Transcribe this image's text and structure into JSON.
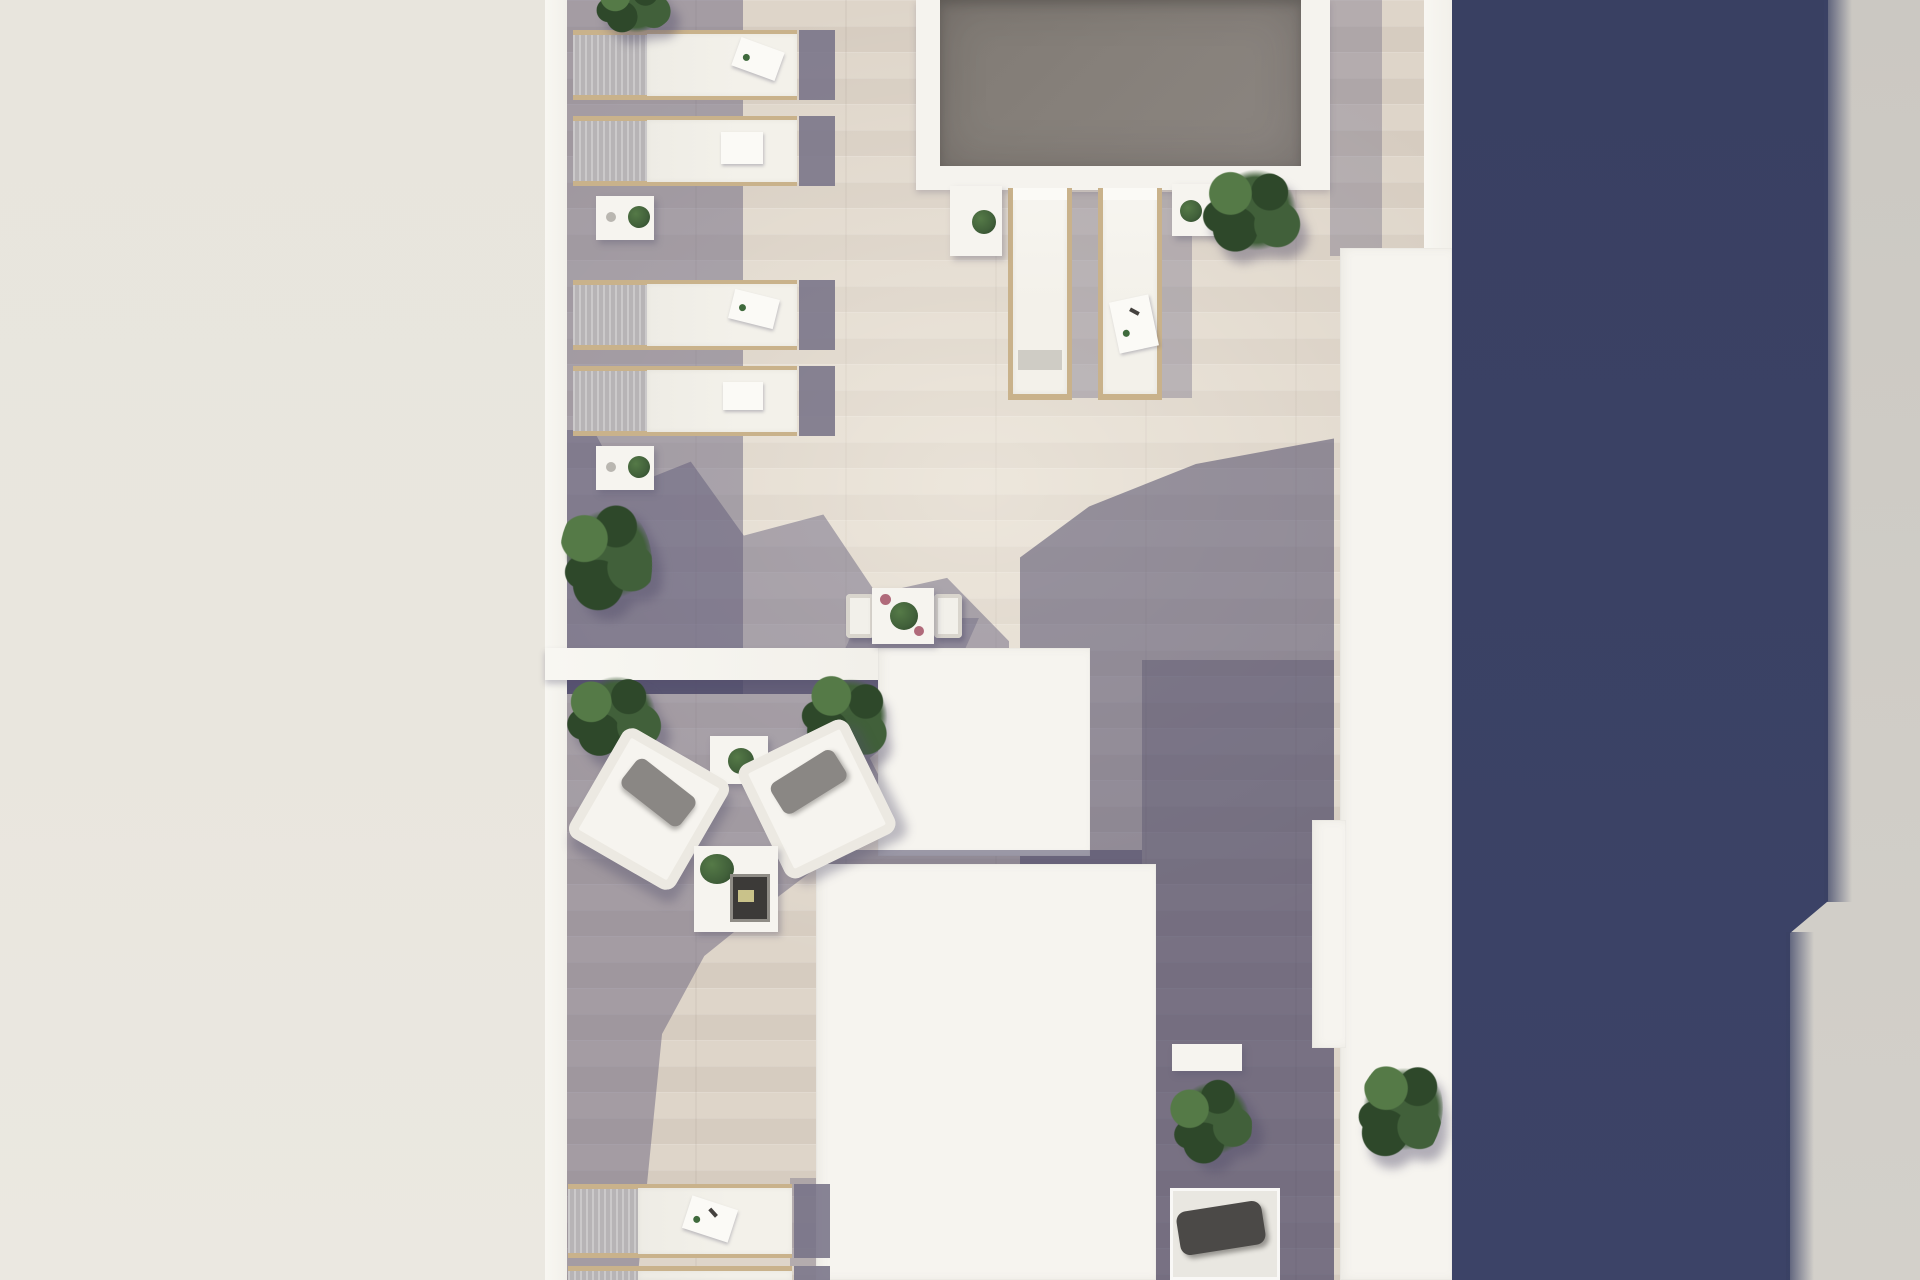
{
  "scene": {
    "label": "Aerial top-down 3D rendering of a rooftop terrace with plunge pool, sun deck and lounge area",
    "view": "top-down architectural render",
    "areas": {
      "pool_area": "gray plunge pool with white coping at top center",
      "sun_deck": "upper terrace with rows of cushioned sun loungers along the left parapet and two loungers beside the pool",
      "lounge_area": "lower terrace with two white armchairs, side table and coffee table with plants and books",
      "bistro_corner": "small white bistro table with two chairs and potted plant",
      "rooftop_volumes": "white roof structures / skylight boxes in the center-right",
      "right_walkway": "tiled walkway in deep shade with bench, planter bushes and daybed",
      "neighbor_left": "plain cream neighbouring roof plane on the left",
      "building_shadow": "tall navy-blue building shadow cast over the right walkway",
      "street_strip": "light gray strip along the far right edge"
    }
  },
  "inventory": {
    "sun_loungers_left_rows": 4,
    "sun_loungers_poolside": 2,
    "sun_loungers_bottom": 2,
    "plant_side_tables": 5,
    "bistro_tables": 1,
    "bistro_chairs": 2,
    "armchairs": 2,
    "coffee_tables": 1,
    "bushes": 7,
    "daybeds": 1,
    "benches": 1,
    "pools": 1
  },
  "palette": {
    "cream": "#e8e5dd",
    "wall_white": "#f8f7f2",
    "box_white": "#f6f4ef",
    "deck_light": "#ded5c9",
    "deck_mid": "#d6ccc0",
    "pool_water": "#86807a",
    "pool_coping": "#f5f3ee",
    "navy": "#3a4164",
    "side_gray": "#cbc8c2",
    "foliage": "#41603a",
    "foliage_dark": "#2e482a",
    "foliage_light": "#557a47",
    "wood": "#c9b28b",
    "mesh": "#b7b4b6",
    "cushion": "#f3f1ea",
    "flap": "#787387",
    "pillow": "#8a8784",
    "daybed_pillow": "#4b4947"
  }
}
